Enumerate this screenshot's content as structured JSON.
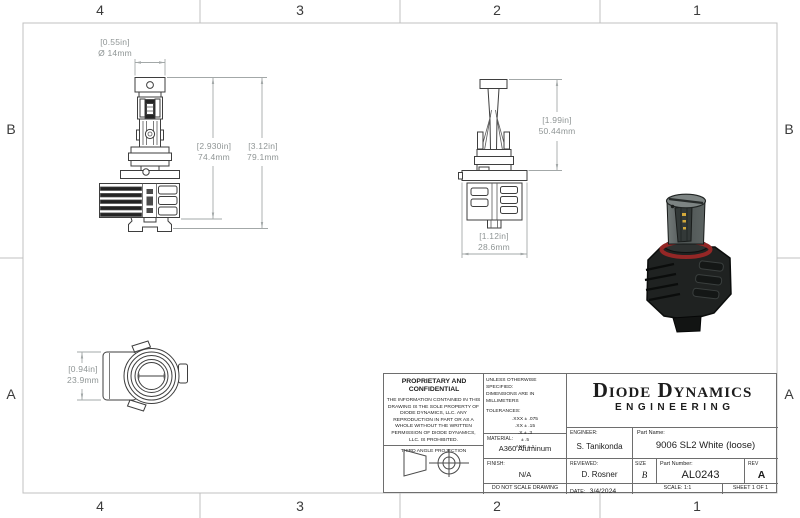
{
  "zones": {
    "columns": [
      "4",
      "3",
      "2",
      "1"
    ],
    "rows": [
      "B",
      "A"
    ]
  },
  "dimensions": {
    "front_diameter": {
      "inches": "[0.55in]",
      "metric": "Ø 14mm"
    },
    "front_body_height": {
      "inches": "[2.930in]",
      "metric": "74.4mm"
    },
    "front_total_height": {
      "inches": "[3.12in]",
      "metric": "79.1mm"
    },
    "side_height": {
      "inches": "[1.99in]",
      "metric": "50.44mm"
    },
    "side_width": {
      "inches": "[1.12in]",
      "metric": "28.6mm"
    },
    "top_height": {
      "inches": "[0.94in]",
      "metric": "23.9mm"
    }
  },
  "title_block": {
    "proprietary_heading": "PROPRIETARY AND CONFIDENTIAL",
    "proprietary_body": "THE INFORMATION CONTAINED IN THIS DRAWING IS THE SOLE PROPERTY OF DIODE DYNAMICS, LLC.  ANY REPRODUCTION IN PART OR AS A WHOLE WITHOUT THE WRITTEN PERMISSION OF DIODE DYNAMICS, LLC. IS PROHIBITED.",
    "projection_label": "THIRD ANGLE PROJECTION",
    "spec_note_1": "UNLESS OTHERWISE SPECIFIED:",
    "spec_note_2": "DIMENSIONS ARE IN MILLIMETERS",
    "tolerances_label": "TOLERANCES:",
    "tolerances": [
      ".XXX ± .075",
      ".XX ± .15",
      ".X ± .3",
      "± .5",
      "ANG ± 1"
    ],
    "material_label": "MATERIAL:",
    "material": "A360 Aluminum",
    "finish_label": "FINISH:",
    "finish": "N/A",
    "do_not_scale": "DO NOT SCALE DRAWING",
    "brand_line1": "Diode Dynamics",
    "brand_line2": "ENGINEERING",
    "engineer_label": "ENGINEER:",
    "engineer": "S. Tanikonda",
    "reviewed_label": "REVIEWED:",
    "reviewed": "D. Rosner",
    "part_name_label": "Part Name:",
    "part_name": "9006 SL2 White (loose)",
    "size_label": "SIZE",
    "size": "B",
    "part_number_label": "Part Number:",
    "part_number": "AL0243",
    "rev_label": "REV",
    "rev": "A",
    "date_label": "DATE:",
    "date": "3/4/2024",
    "scale": "SCALE: 1:1",
    "sheet": "SHEET 1 OF 1"
  },
  "colors": {
    "drawing_line": "#3e3e3e",
    "dimension_line": "#a3a8a8",
    "dimension_text": "#8f9595",
    "frame_line": "#c0c0c0",
    "render_cap": "#7d8483",
    "render_body": "#565d5c",
    "render_heatsink": "#1f2221",
    "render_oring": "#942726",
    "render_led_chip": "#d2a83a"
  }
}
